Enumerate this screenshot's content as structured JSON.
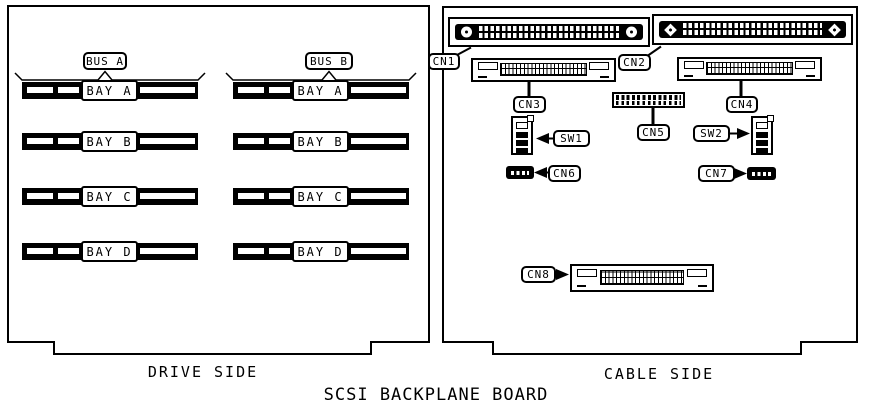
{
  "figure_code": "MH1991B",
  "title": "SCSI BACKPLANE BOARD",
  "colors": {
    "ink": "#000000",
    "paper": "#ffffff"
  },
  "drive_side": {
    "caption": "DRIVE SIDE",
    "columns": [
      {
        "bus": "BUS A",
        "bays": [
          "BAY A",
          "BAY B",
          "BAY C",
          "BAY D"
        ]
      },
      {
        "bus": "BUS B",
        "bays": [
          "BAY A",
          "BAY B",
          "BAY C",
          "BAY D"
        ]
      }
    ]
  },
  "cable_side": {
    "caption": "CABLE SIDE",
    "connectors": [
      "CN1",
      "CN2",
      "CN3",
      "CN4",
      "CN5",
      "CN6",
      "CN7",
      "CN8"
    ],
    "switches": [
      "SW1",
      "SW2"
    ]
  }
}
